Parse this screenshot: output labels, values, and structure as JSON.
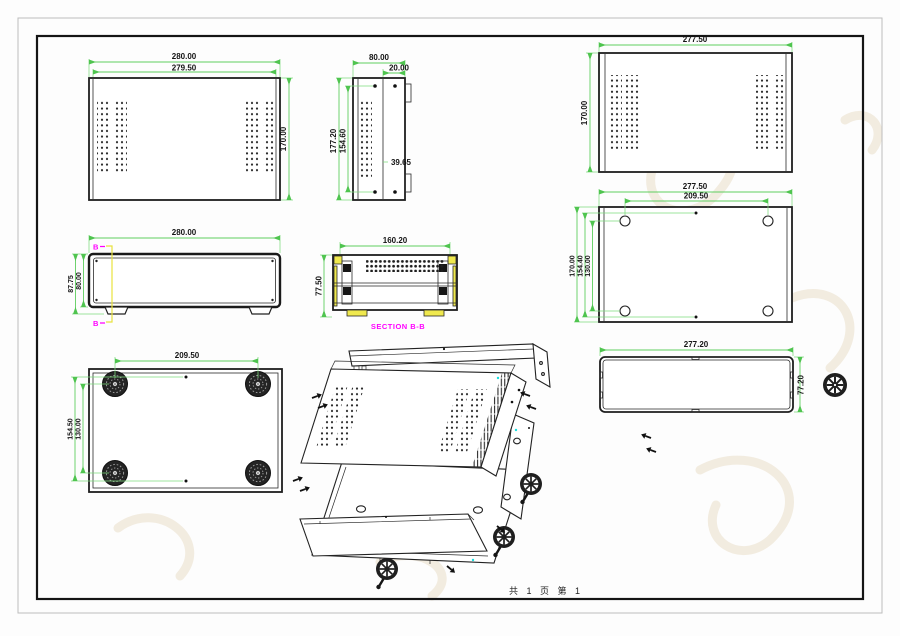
{
  "sheet": {
    "footer_text": "共 1 页  第 1",
    "colors": {
      "dimension_green": "#5fce5f",
      "section_magenta": "#ff00ff",
      "section_yellow": "#f0e94e",
      "line_black": "#1e1e1e",
      "accent_cyan": "#19dede",
      "watermark_tan": "#e9dfc9"
    }
  },
  "views": {
    "top_cover_outside": {
      "dim_width_outer": "280.00",
      "dim_width_inner": "279.50",
      "dim_height": "170.00"
    },
    "side_view": {
      "dim_width": "80.00",
      "dim_tab": "20.00",
      "dim_height": "177.20",
      "dim_screw_span": "154.60",
      "dim_mid": "39.65"
    },
    "top_cover_inside": {
      "dim_width": "277.50",
      "dim_height": "170.00"
    },
    "front_view": {
      "dim_width": "280.00",
      "dim_height_total": "87.75",
      "dim_height_body": "80.00",
      "section_marker": "B"
    },
    "section_view": {
      "label": "SECTION B-B",
      "dim_width": "160.20",
      "dim_height": "77.50"
    },
    "base_plate": {
      "dim_width": "277.50",
      "dim_hole_span_x": "209.50",
      "dim_height": "170.00",
      "dim_dot_span": "154.40",
      "dim_hole_span_y": "130.00"
    },
    "bottom_view": {
      "dim_hole_span_x": "209.50",
      "dim_dot_span": "154.50",
      "dim_hole_span_y": "130.00"
    },
    "rear_panel": {
      "dim_width": "277.20",
      "dim_height": "77.20"
    }
  }
}
